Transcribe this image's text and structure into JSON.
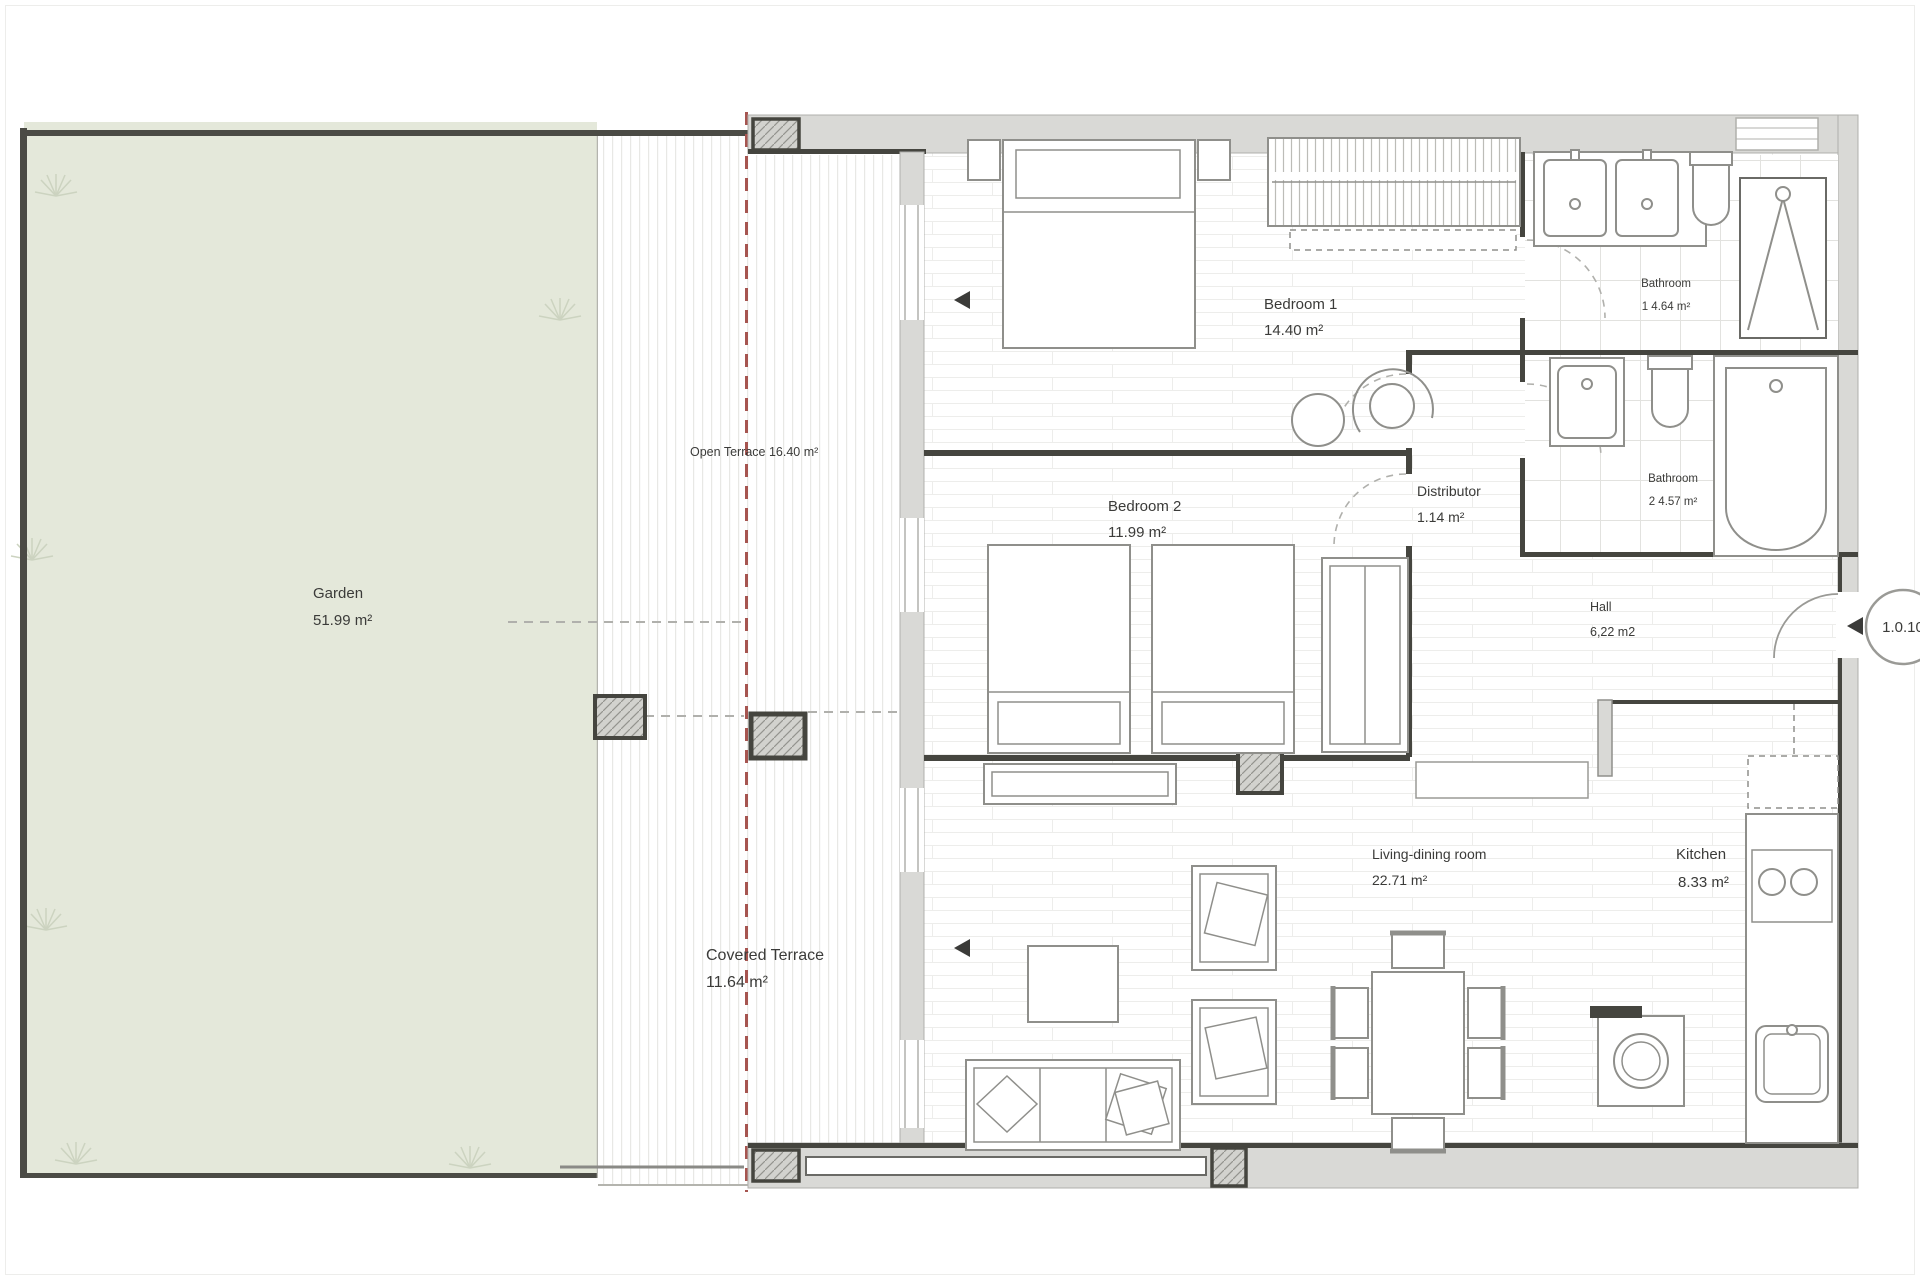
{
  "plan": {
    "rooms": {
      "garden": {
        "name": "Garden",
        "area": "51.99 m²"
      },
      "open_terrace": {
        "name": "Open Terrace 16.40 m²"
      },
      "covered_terrace": {
        "name": "Covered Terrace",
        "area": "11.64 m²"
      },
      "bedroom1": {
        "name": "Bedroom 1",
        "area": "14.40 m²"
      },
      "bedroom2": {
        "name": "Bedroom 2",
        "area": "11.99 m²"
      },
      "distributor": {
        "name": "Distributor",
        "area": "1.14 m²"
      },
      "bathroom1": {
        "name": "Bathroom",
        "area": "1 4.64 m²"
      },
      "bathroom2": {
        "name": "Bathroom",
        "area": "2 4.57 m²"
      },
      "hall": {
        "name": "Hall",
        "area": "6,22 m2"
      },
      "living_dining": {
        "name": "Living-dining room",
        "area": "22.71 m²"
      },
      "kitchen": {
        "name": "Kitchen",
        "area": "8.33 m²"
      }
    },
    "door_reference": "1.0.10",
    "colors": {
      "garden_fill": "#e4e8da",
      "wall_fill": "#d9d9d6",
      "wall_dark": "#45453f",
      "axis_red": "#a65550"
    }
  }
}
